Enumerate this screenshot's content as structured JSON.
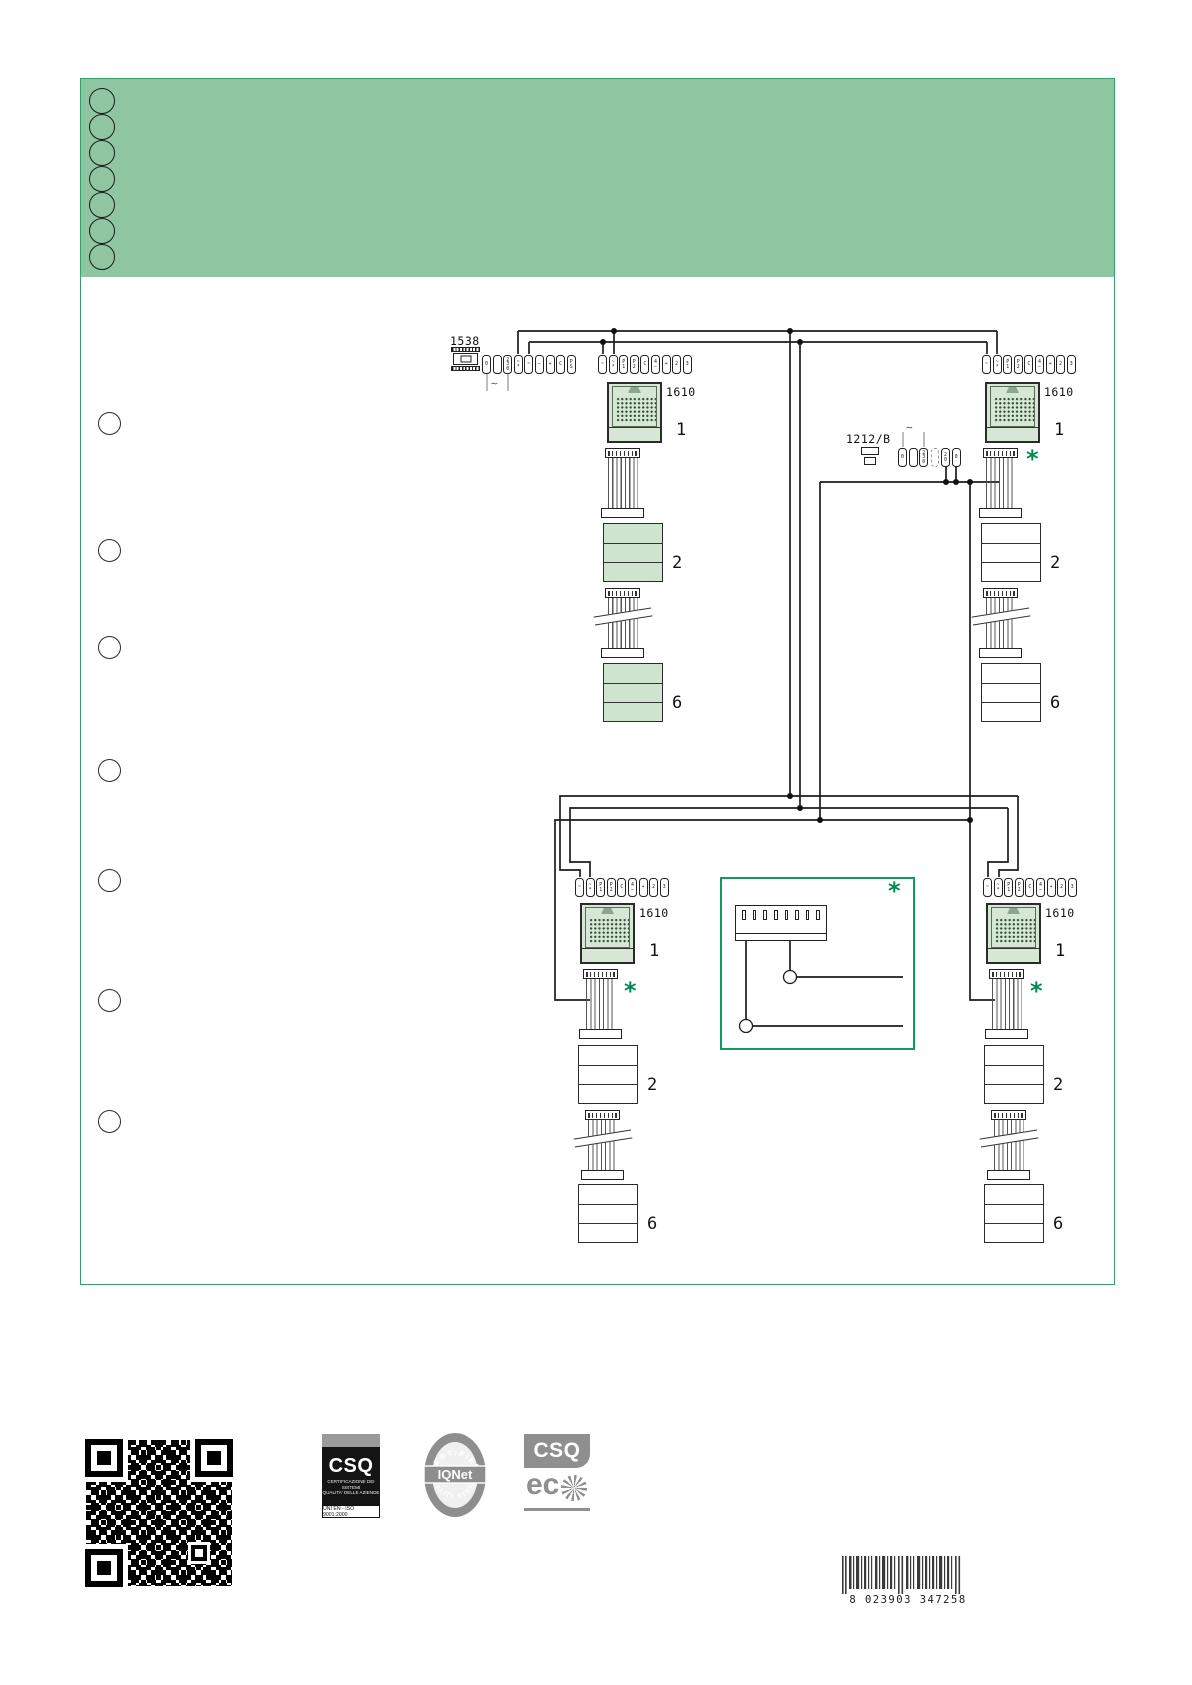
{
  "colors": {
    "band": "#8fc6a1",
    "frame": "#36a06b",
    "unit_fill": "#d6e8d5",
    "asterisk": "#008a52",
    "inset_border": "#12995f"
  },
  "diagram": {
    "asterisk": "*",
    "psu_main": {
      "label": "1538",
      "ac": "∼",
      "terminals": [
        "0",
        "",
        "2\n3\n0",
        "~\n*",
        "~",
        "−",
        "+",
        "C",
        "P\nS"
      ]
    },
    "psu_aux": {
      "label": "1212/B",
      "ac": "∼",
      "terminals_in": [
        "0",
        "",
        "2\n3\n0"
      ],
      "terminals_out": [
        "2\n0",
        "0"
      ]
    },
    "columns": [
      {
        "id": "top-left",
        "strip": [
          "~",
          "~\n*",
          "P\n1",
          "P\n2",
          "C",
          "4\n−",
          "+",
          "2",
          "3"
        ],
        "unit_label": "1610",
        "unit_no": "1",
        "mid_no": "2",
        "bot_no": "6"
      },
      {
        "id": "top-right",
        "strip": [
          "~",
          "~\n*",
          "P\n1",
          "P\n2",
          "C",
          "4\n−",
          "+",
          "2",
          "3"
        ],
        "unit_label": "1610",
        "unit_no": "1",
        "mid_no": "2",
        "bot_no": "6"
      },
      {
        "id": "bottom-left",
        "strip": [
          "~",
          "~\n*",
          "P\n1",
          "P\n2",
          "C",
          "4\n−",
          "+",
          "2",
          "3"
        ],
        "unit_label": "1610",
        "unit_no": "1",
        "mid_no": "2",
        "bot_no": "6"
      },
      {
        "id": "bottom-right",
        "strip": [
          "~",
          "~\n*",
          "P\n1",
          "P\n2",
          "C",
          "4\n−",
          "+",
          "2",
          "3"
        ],
        "unit_label": "1610",
        "unit_no": "1",
        "mid_no": "2",
        "bot_no": "6"
      }
    ]
  },
  "footer": {
    "csq": {
      "name": "CSQ",
      "line1": "CERTIFICAZIONE DEI SISTEMI",
      "line2": "QUALITA' DELLE AZIENDE",
      "iso": "UNI EN - ISO 9001:2000"
    },
    "iqnet": {
      "arc_top": "CERTIFIED",
      "arc_bottom": "QUALITY SYSTEM",
      "name": "IQNet"
    },
    "csq_eco": {
      "name": "CSQ",
      "text": "ec"
    },
    "barcode": {
      "digits": "8 023903 347258"
    }
  }
}
